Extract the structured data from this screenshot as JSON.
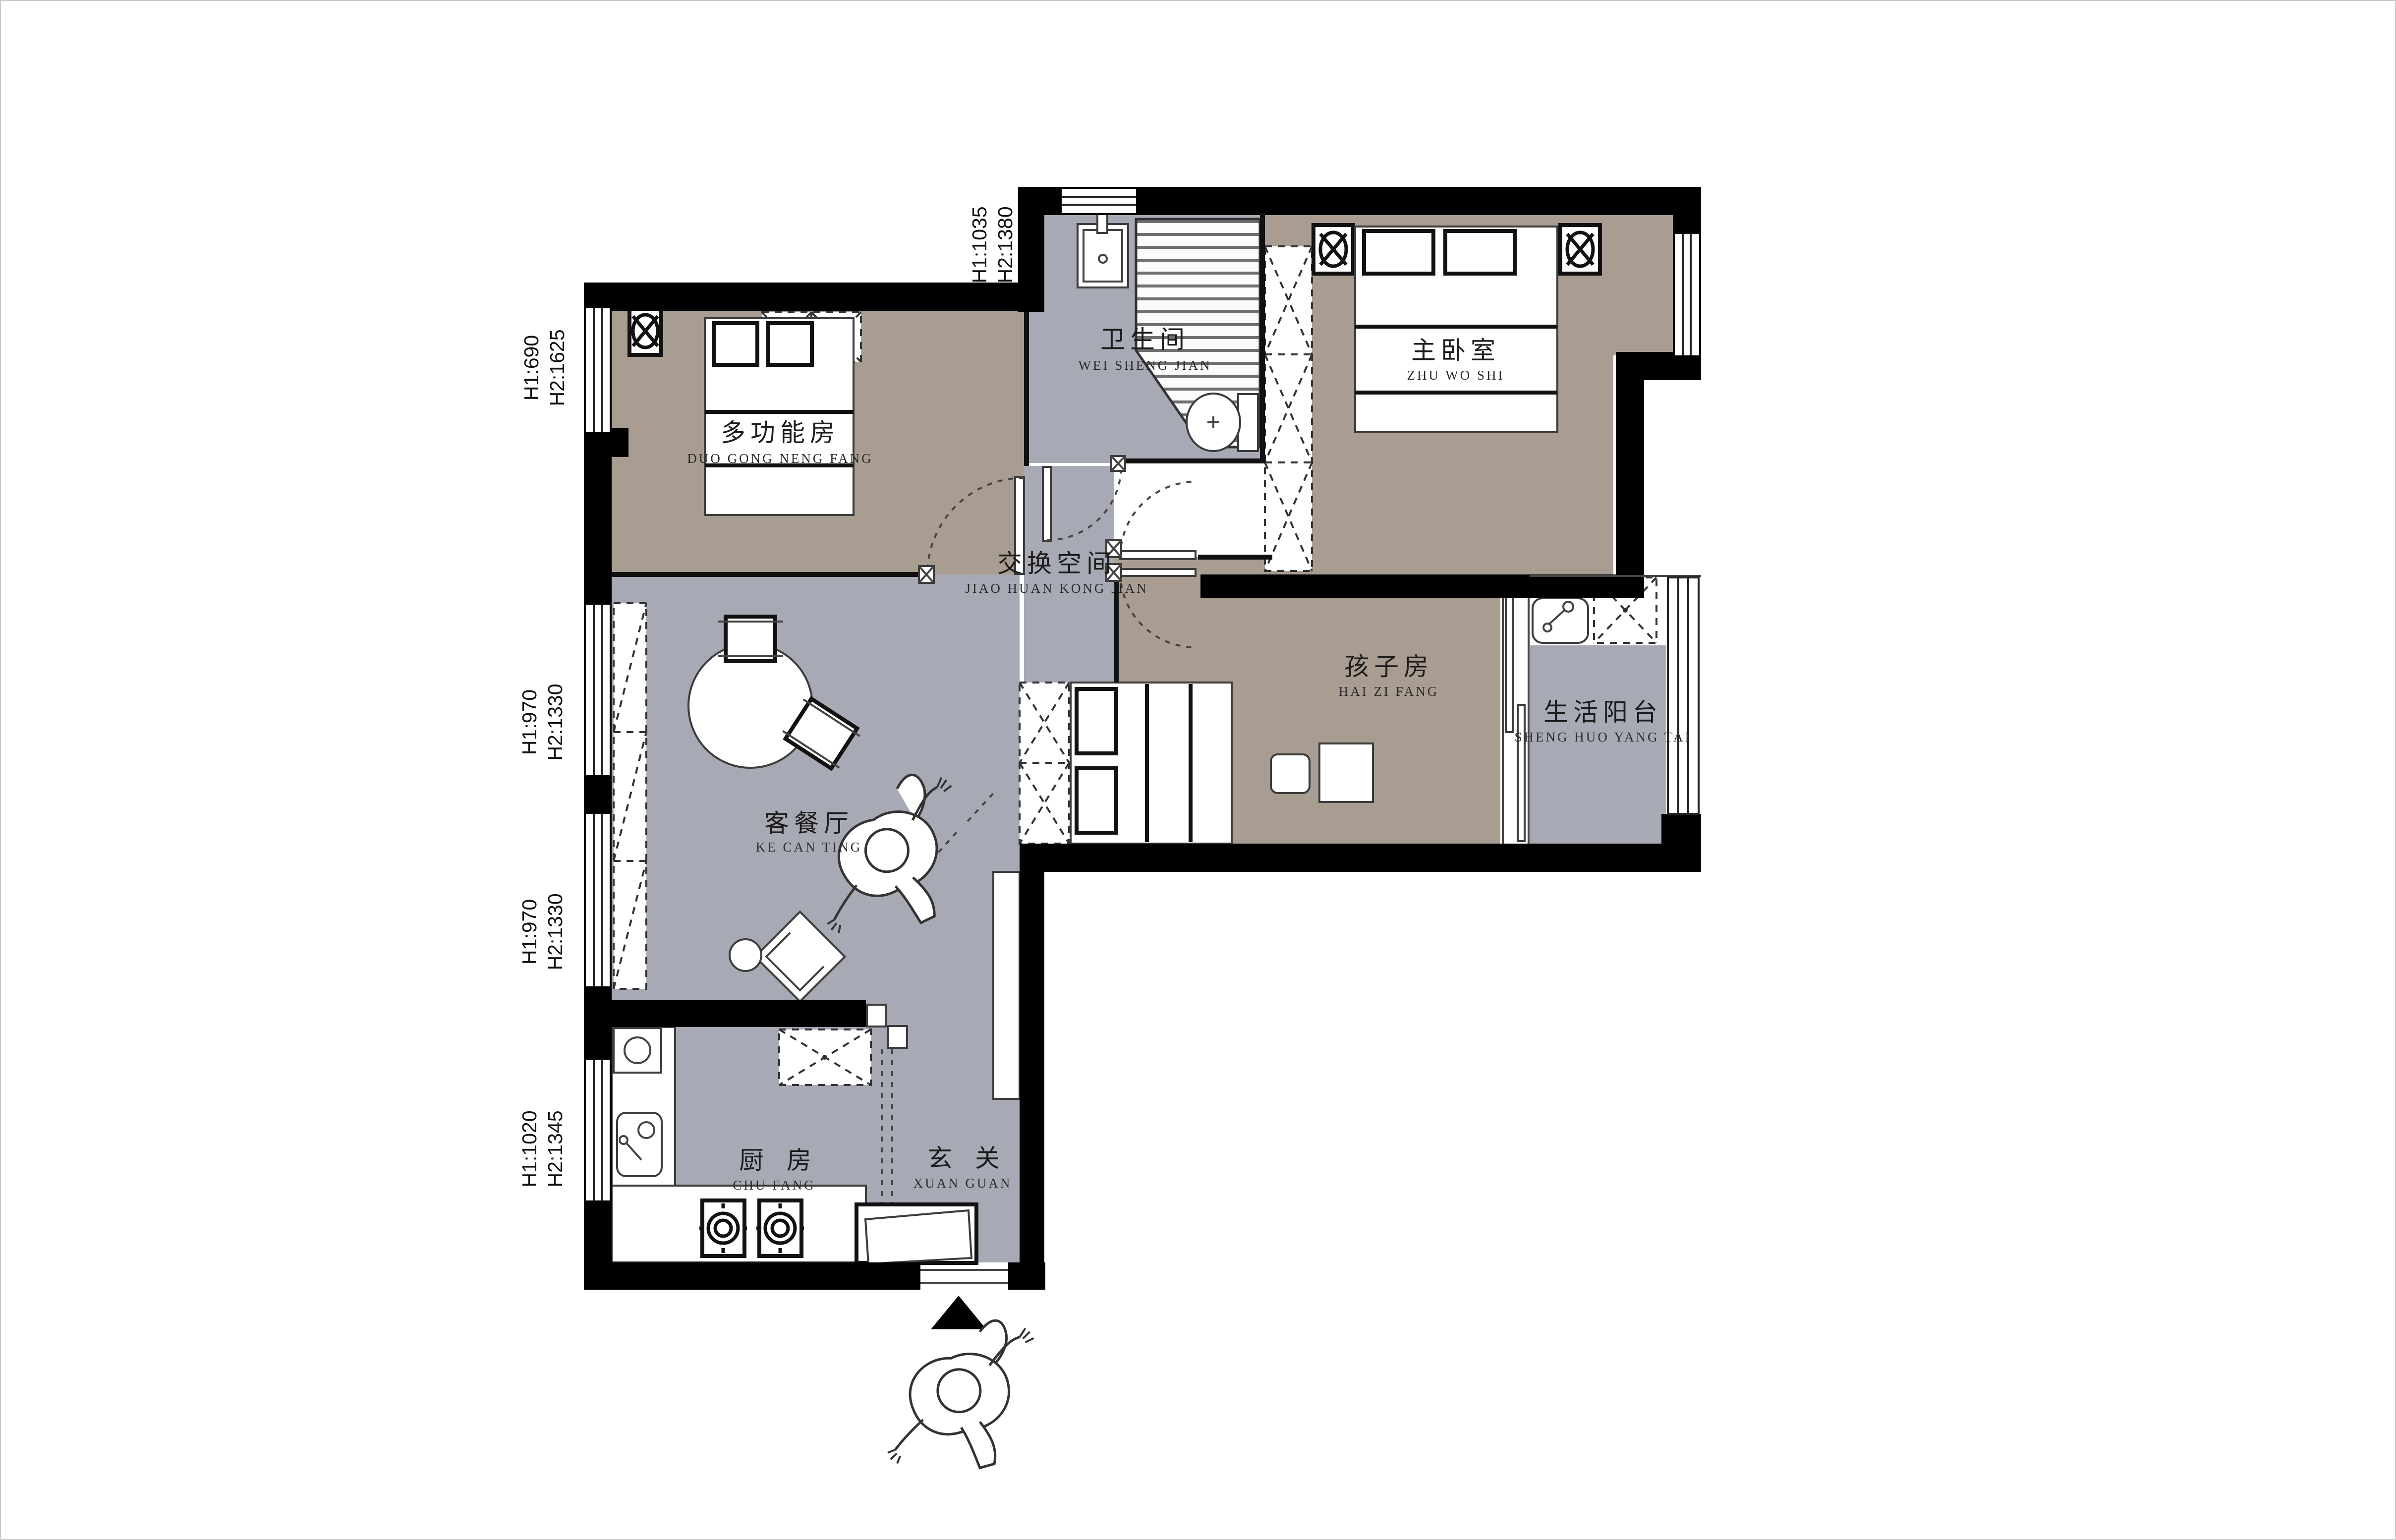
{
  "rooms": [
    {
      "id": "multi-function-room",
      "name": "多功能房",
      "pinyin": "DUO GONG NENG FANG"
    },
    {
      "id": "bathroom",
      "name": "卫生间",
      "pinyin": "WEI SHENG JIAN"
    },
    {
      "id": "master-bedroom",
      "name": "主卧室",
      "pinyin": "ZHU WO SHI"
    },
    {
      "id": "exchange-space",
      "name": "交换空间",
      "pinyin": "JIAO HUAN KONG JIAN"
    },
    {
      "id": "kids-room",
      "name": "孩子房",
      "pinyin": "HAI ZI FANG"
    },
    {
      "id": "service-balcony",
      "name": "生活阳台",
      "pinyin": "SHENG HUO YANG TAI"
    },
    {
      "id": "living-dining-room",
      "name": "客餐厅",
      "pinyin": "KE CAN TING"
    },
    {
      "id": "kitchen",
      "name": "厨房",
      "pinyin": "CHU FANG"
    },
    {
      "id": "entry",
      "name": "玄关",
      "pinyin": "XUAN GUAN"
    }
  ],
  "window_annotations": [
    {
      "id": "top-window",
      "h1": "H1:1035",
      "h2": "H2:1380"
    },
    {
      "id": "left-window-1",
      "h1": "H1:690",
      "h2": "H2:1625"
    },
    {
      "id": "left-window-2",
      "h1": "H1:970",
      "h2": "H2:1330"
    },
    {
      "id": "left-window-3",
      "h1": "H1:970",
      "h2": "H2:1330"
    },
    {
      "id": "left-window-4",
      "h1": "H1:1020",
      "h2": "H2:1345"
    }
  ],
  "colors": {
    "wall": "#000000",
    "floor_warm": "#a89d90",
    "floor_cool": "#a7aab4",
    "fixture_white": "#ffffff",
    "outline": "#333333"
  }
}
